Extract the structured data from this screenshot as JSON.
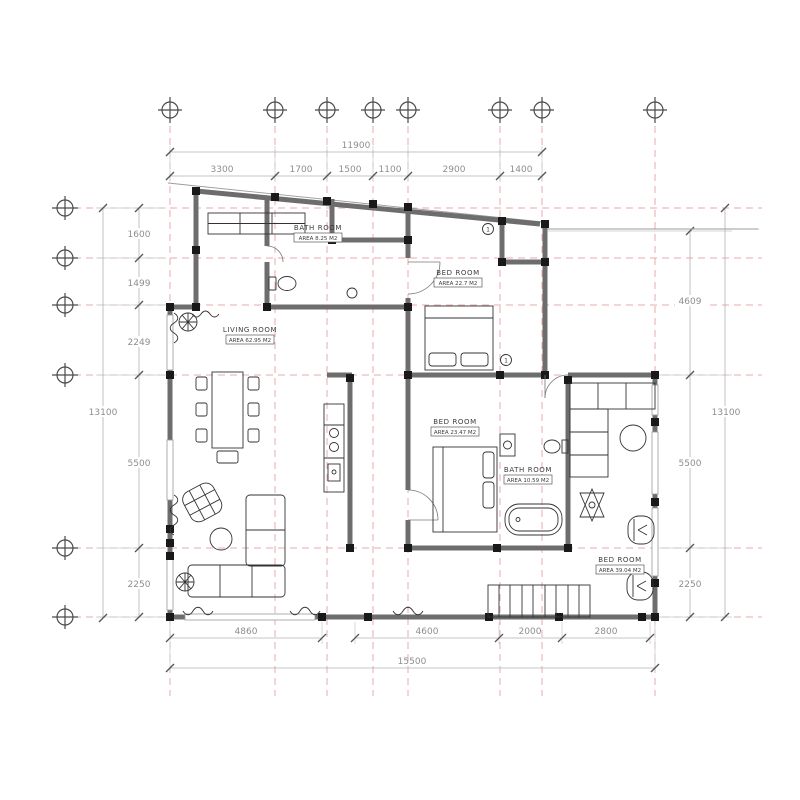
{
  "drawing": {
    "type": "architectural floor plan"
  },
  "colors": {
    "grid_axis": "#eaa9a9",
    "wall": "#6d6d6d",
    "column": "#191919",
    "dimension_text": "#8e8e8e",
    "line": "#333333",
    "background": "#ffffff"
  },
  "dimensions": {
    "top": {
      "total": "11900",
      "segments": [
        "3300",
        "1700",
        "1500",
        "1100",
        "2900",
        "1400"
      ]
    },
    "left": {
      "total": "13100",
      "segments": [
        "1600",
        "1499",
        "2249",
        "5500",
        "2250"
      ]
    },
    "right": {
      "total": "13100",
      "segments": [
        "4609",
        "5500",
        "2250"
      ]
    },
    "bottom": {
      "total": "15500",
      "segments": [
        "4860",
        "4600",
        "2000",
        "2800"
      ]
    }
  },
  "rooms": [
    {
      "name": "BATH ROOM",
      "area": "AREA  8.25 M2"
    },
    {
      "name": "BED ROOM",
      "area": "AREA  22.7 M2"
    },
    {
      "name": "LIVING ROOM",
      "area": "AREA  62.95 M2"
    },
    {
      "name": "BED ROOM",
      "area": "AREA  23.47 M2"
    },
    {
      "name": "BATH ROOM",
      "area": "AREA  10.59 M2"
    },
    {
      "name": "BED ROOM",
      "area": "AREA  39.04 M2"
    }
  ],
  "markers": {
    "door_note": "1",
    "bed_note": "1"
  }
}
